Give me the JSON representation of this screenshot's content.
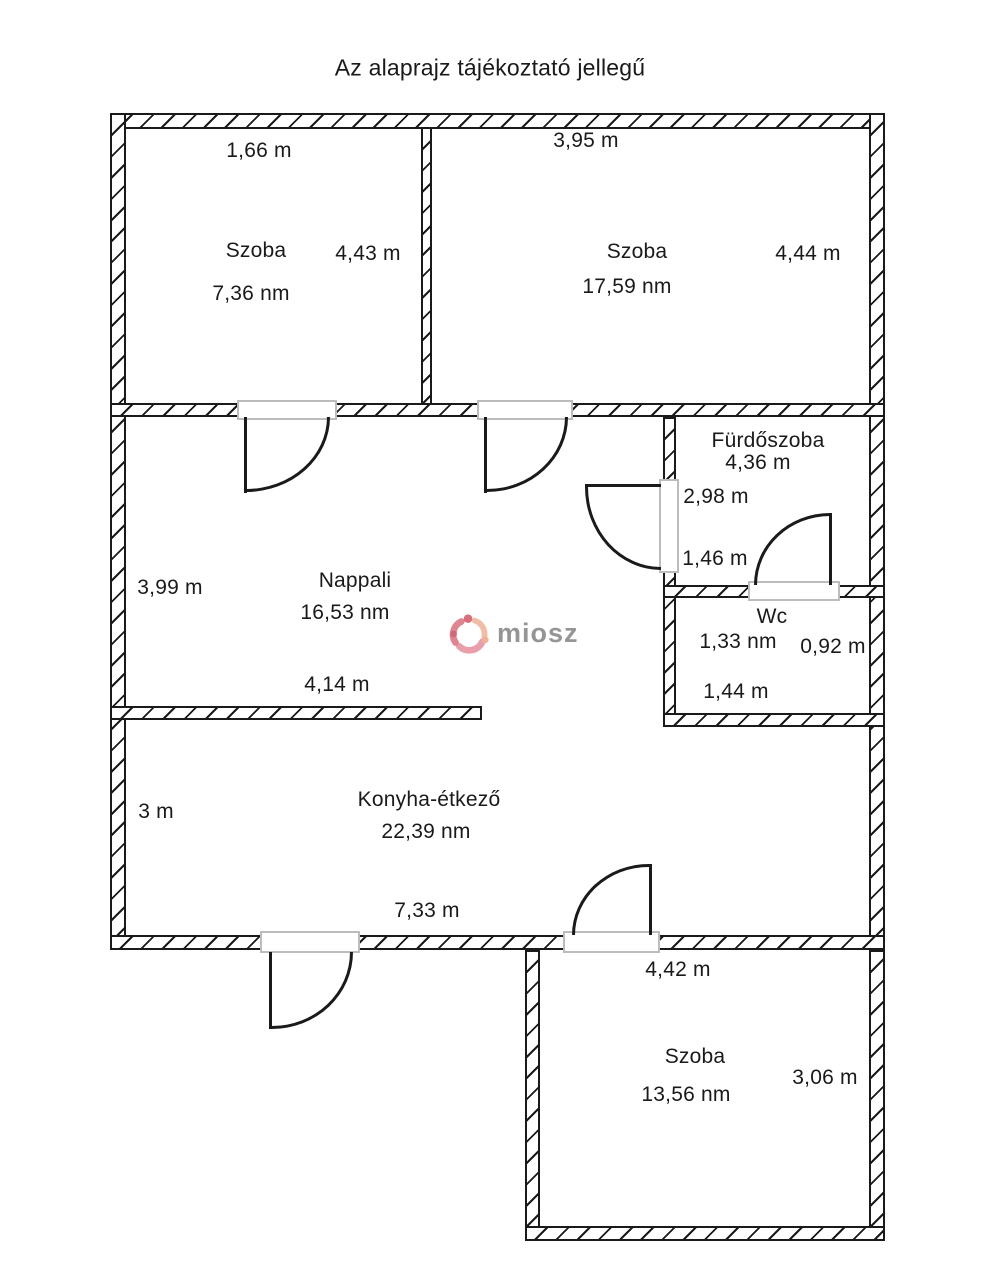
{
  "title": "Az alaprajz tájékoztató jellegű",
  "watermark": {
    "brand": "miosz"
  },
  "colors": {
    "wall_line": "#1a1a1a",
    "sill": "#bcbcbc",
    "background": "#ffffff",
    "watermark_text": "#8a8a8a",
    "watermark_pink": "#d4606f",
    "watermark_peach": "#eda98c"
  },
  "rooms": {
    "szoba1": {
      "name": "Szoba",
      "area": "7,36 nm",
      "width": "1,66 m",
      "height": "4,43 m"
    },
    "szoba2": {
      "name": "Szoba",
      "area": "17,59 nm",
      "width": "3,95 m",
      "height": "4,44 m"
    },
    "nappali": {
      "name": "Nappali",
      "area": "16,53 nm",
      "left": "3,99 m",
      "bottom": "4,14 m"
    },
    "furdoszoba": {
      "name": "Fürdőszoba",
      "area": "4,36 m",
      "dim1": "2,98 m",
      "dim2": "1,46 m"
    },
    "wc": {
      "name": "Wc",
      "area": "1,33 nm",
      "dim1": "0,92 m",
      "dim2": "1,44 m"
    },
    "konyha": {
      "name": "Konyha-étkező",
      "area": "22,39 nm",
      "left": "3 m",
      "bottom": "7,33 m"
    },
    "szoba3": {
      "name": "Szoba",
      "area": "13,56 nm",
      "top": "4,42 m",
      "right": "3,06 m"
    }
  }
}
